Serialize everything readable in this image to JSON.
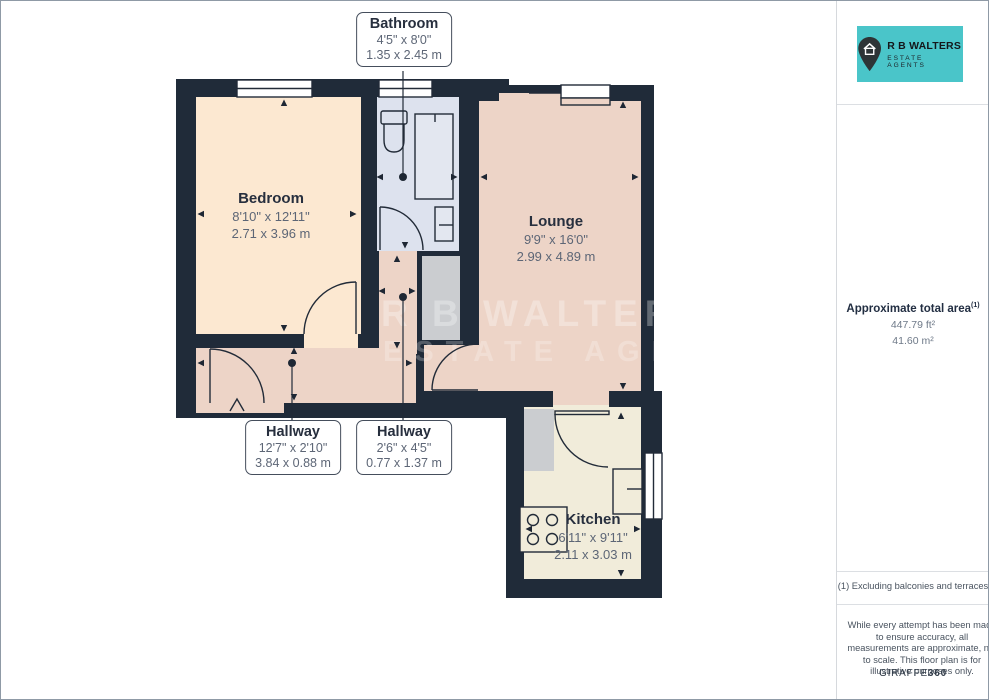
{
  "branding": {
    "logo": {
      "line1": "R B WALTERS",
      "line2": "ESTATE AGENTS",
      "pin_icon": "map-pin-house-icon",
      "bg_color": "#4AC5C9"
    },
    "watermark_line1": "R B WALTERS",
    "watermark_line2": "ESTATE AGENTS"
  },
  "floor_plan": {
    "rooms": {
      "bathroom": {
        "name": "Bathroom",
        "imperial": "4'5\" x 8'0\"",
        "metric": "1.35 x 2.45 m"
      },
      "bedroom": {
        "name": "Bedroom",
        "imperial": "8'10\" x 12'11\"",
        "metric": "2.71 x 3.96 m"
      },
      "lounge": {
        "name": "Lounge",
        "imperial": "9'9\" x 16'0\"",
        "metric": "2.99 x 4.89 m"
      },
      "hallway_long": {
        "name": "Hallway",
        "imperial": "12'7\" x 2'10\"",
        "metric": "3.84 x 0.88 m"
      },
      "hallway_small": {
        "name": "Hallway",
        "imperial": "2'6\" x 4'5\"",
        "metric": "0.77 x 1.37 m"
      },
      "kitchen": {
        "name": "Kitchen",
        "imperial": "6'11\" x 9'11\"",
        "metric": "2.11 x 3.03 m"
      }
    },
    "colors": {
      "wall": "#202B39",
      "bedroom_floor": "#FCE8D1",
      "lounge_floor": "#EDD4C7",
      "bathroom_floor": "#DDE2EE",
      "kitchen_floor": "#F1ECDA",
      "storage": "#CBCDD0"
    }
  },
  "sidebar": {
    "area": {
      "title": "Approximate total area",
      "marker": "(1)",
      "imperial": "447.79 ft²",
      "metric": "41.60 m²"
    },
    "footnote": "(1) Excluding balconies and terraces",
    "disclaimer": "While every attempt has been made to ensure accuracy, all measurements are approximate, not to scale. This floor plan is for illustrative purposes only.",
    "provider_name": "GIRAFFE",
    "provider_suffix": "360"
  }
}
